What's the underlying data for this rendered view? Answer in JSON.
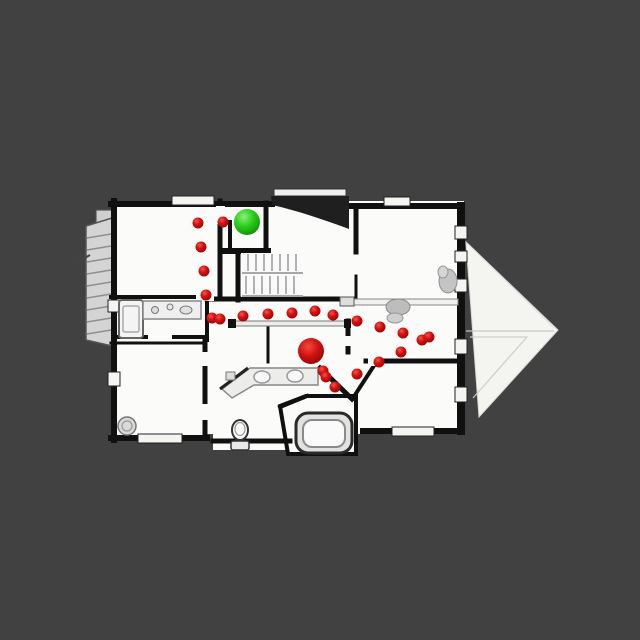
{
  "canvas": {
    "name": "topdown-floorplan-viewer",
    "background_color": "#414141",
    "width": 640,
    "height": 640
  },
  "map": {
    "floor_color": "#fbfbfa",
    "wall_color": "#111111",
    "roof_color": "#f4f4f1",
    "start_marker": {
      "label": "green-sphere-start",
      "color": "#2fd01f",
      "x": 247,
      "y": 222,
      "radius": 13
    },
    "goal_marker": {
      "label": "red-sphere-goal",
      "color": "#d41414",
      "x": 311,
      "y": 351,
      "radius": 13
    },
    "waypoints": {
      "label": "red-path-dots",
      "color": "#d01212",
      "radius": 5.5,
      "points": [
        [
          223,
          222
        ],
        [
          198,
          223
        ],
        [
          201,
          247
        ],
        [
          204,
          271
        ],
        [
          206,
          295
        ],
        [
          212,
          318
        ],
        [
          220,
          319
        ],
        [
          243,
          316
        ],
        [
          268,
          314
        ],
        [
          292,
          313
        ],
        [
          315,
          311
        ],
        [
          333,
          315
        ],
        [
          357,
          321
        ],
        [
          380,
          327
        ],
        [
          403,
          333
        ],
        [
          422,
          340
        ],
        [
          429,
          337
        ],
        [
          401,
          352
        ],
        [
          379,
          362
        ],
        [
          357,
          374
        ],
        [
          323,
          371
        ],
        [
          326,
          377
        ],
        [
          335,
          387
        ]
      ]
    }
  }
}
